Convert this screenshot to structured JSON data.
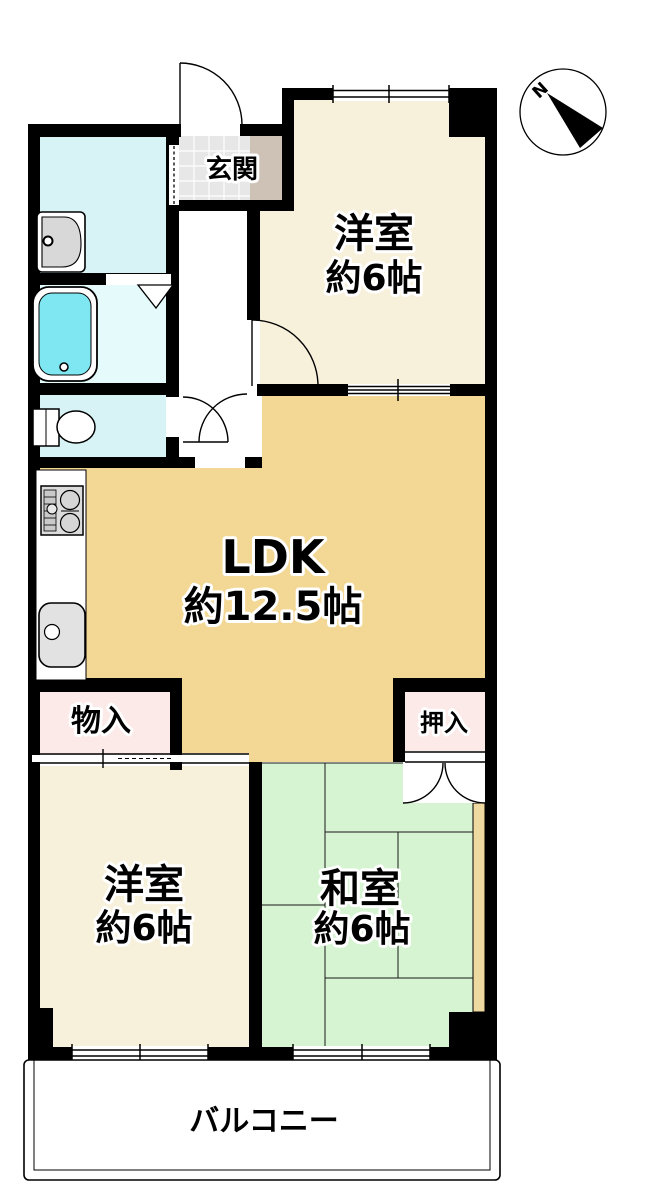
{
  "floorplan": {
    "compass_label": "N",
    "rooms": {
      "genkan": {
        "label": "玄関"
      },
      "bedroom_ne": {
        "label": "洋室",
        "size": "約6帖"
      },
      "ldk": {
        "label": "LDK",
        "size": "約12.5帖"
      },
      "storage": {
        "label": "物入"
      },
      "closet": {
        "label": "押入"
      },
      "bedroom_sw": {
        "label": "洋室",
        "size": "約6帖"
      },
      "tatami_room": {
        "label": "和室",
        "size": "約6帖"
      },
      "balcony": {
        "label": "バルコニー"
      }
    },
    "colors": {
      "wall": "#000000",
      "ldk_floor": "#F3D795",
      "bedroom_floor": "#F7F0DB",
      "tatami_floor": "#D6F3D2",
      "closet_floor": "#FBEAE8",
      "wet_floor": "#D7F3F6",
      "bath_floor": "#E4FAFB",
      "tub": "#7EE7F1",
      "tile": "#E7E7E7",
      "hall_step": "#CDC2B5",
      "edge_board": "#EED9A1"
    }
  }
}
